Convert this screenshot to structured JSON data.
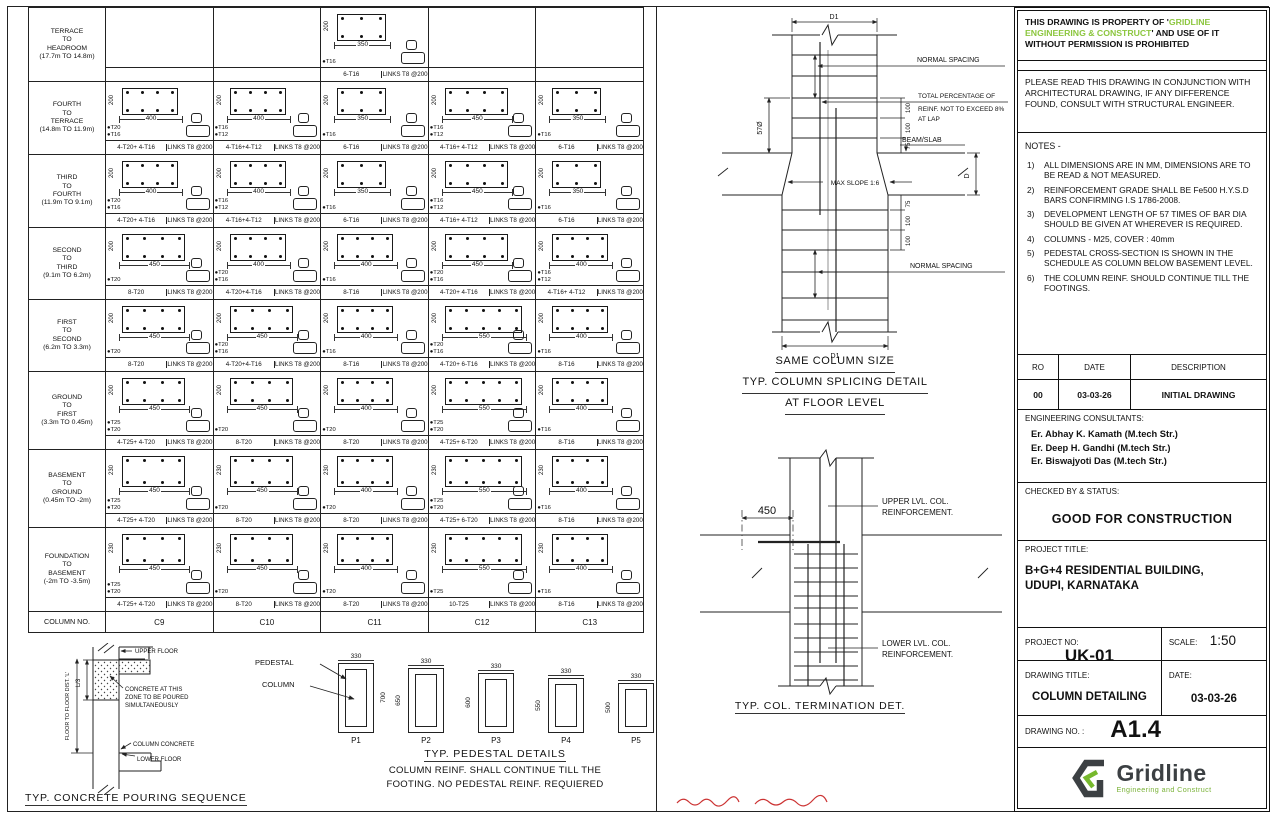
{
  "colors": {
    "accent_green": "#8cc63e",
    "logo_dark": "#3c4043",
    "logo_green": "#76b82d",
    "red_mark": "#cc3333",
    "line": "#222222"
  },
  "schedule": {
    "column_no_label": "COLUMN NO.",
    "columns": [
      "C9",
      "C10",
      "C11",
      "C12",
      "C13"
    ],
    "row_heights": [
      74,
      73,
      73,
      72,
      72,
      78,
      78,
      84
    ],
    "rows": [
      {
        "level": [
          "TERRACE",
          "TO",
          "HEADROOM",
          "(17.7m TO 14.8m)"
        ],
        "cells": [
          null,
          null,
          {
            "w": 350,
            "h": 200,
            "bars": [
              "T16"
            ],
            "main": "6-T16",
            "links": "LINKS T8 @200",
            "n": 6
          },
          null,
          null
        ]
      },
      {
        "level": [
          "FOURTH",
          "TO",
          "TERRACE",
          "(14.8m TO 11.9m)"
        ],
        "cells": [
          {
            "w": 400,
            "h": 200,
            "bars": [
              "T20",
              "T16"
            ],
            "main": "4-T20+ 4-T16",
            "links": "LINKS T8 @200",
            "n": 8
          },
          {
            "w": 400,
            "h": 200,
            "bars": [
              "T16",
              "T12"
            ],
            "main": "4-T16+4-T12",
            "links": "LINKS T8 @200",
            "n": 8
          },
          {
            "w": 350,
            "h": 200,
            "bars": [
              "T16"
            ],
            "main": "6-T16",
            "links": "LINKS T8 @200",
            "n": 6
          },
          {
            "w": 450,
            "h": 200,
            "bars": [
              "T16",
              "T12"
            ],
            "main": "4-T16+ 4-T12",
            "links": "LINKS T8 @200",
            "n": 8
          },
          {
            "w": 350,
            "h": 200,
            "bars": [
              "T16"
            ],
            "main": "6-T16",
            "links": "LINKS T8 @200",
            "n": 6
          }
        ]
      },
      {
        "level": [
          "THIRD",
          "TO",
          "FOURTH",
          "(11.9m TO 9.1m)"
        ],
        "cells": [
          {
            "w": 400,
            "h": 200,
            "bars": [
              "T20",
              "T16"
            ],
            "main": "4-T20+ 4-T16",
            "links": "LINKS T8 @200",
            "n": 8
          },
          {
            "w": 400,
            "h": 200,
            "bars": [
              "T16",
              "T12"
            ],
            "main": "4-T16+4-T12",
            "links": "LINKS T8 @200",
            "n": 8
          },
          {
            "w": 350,
            "h": 200,
            "bars": [
              "T16"
            ],
            "main": "6-T16",
            "links": "LINKS T8 @200",
            "n": 6
          },
          {
            "w": 450,
            "h": 200,
            "bars": [
              "T16",
              "T12"
            ],
            "main": "4-T16+ 4-T12",
            "links": "LINKS T8 @200",
            "n": 8
          },
          {
            "w": 350,
            "h": 200,
            "bars": [
              "T16"
            ],
            "main": "6-T16",
            "links": "LINKS T8 @200",
            "n": 6
          }
        ]
      },
      {
        "level": [
          "SECOND",
          "TO",
          "THIRD",
          "(9.1m TO 6.2m)"
        ],
        "cells": [
          {
            "w": 450,
            "h": 200,
            "bars": [
              "T20"
            ],
            "main": "8-T20",
            "links": "LINKS T8 @200",
            "n": 8
          },
          {
            "w": 400,
            "h": 200,
            "bars": [
              "T20",
              "T16"
            ],
            "main": "4-T20+4-T16",
            "links": "LINKS T8 @200",
            "n": 8
          },
          {
            "w": 400,
            "h": 200,
            "bars": [
              "T16"
            ],
            "main": "8-T16",
            "links": "LINKS T8 @200",
            "n": 8
          },
          {
            "w": 450,
            "h": 200,
            "bars": [
              "T20",
              "T16"
            ],
            "main": "4-T20+ 4-T16",
            "links": "LINKS T8 @200",
            "n": 8
          },
          {
            "w": 400,
            "h": 200,
            "bars": [
              "T16",
              "T12"
            ],
            "main": "4-T16+ 4-T12",
            "links": "LINKS T8 @200",
            "n": 8
          }
        ]
      },
      {
        "level": [
          "FIRST",
          "TO",
          "SECOND",
          "(6.2m TO 3.3m)"
        ],
        "cells": [
          {
            "w": 450,
            "h": 200,
            "bars": [
              "T20"
            ],
            "main": "8-T20",
            "links": "LINKS T8 @200",
            "n": 8
          },
          {
            "w": 450,
            "h": 200,
            "bars": [
              "T20",
              "T16"
            ],
            "main": "4-T20+4-T16",
            "links": "LINKS T8 @200",
            "n": 8
          },
          {
            "w": 400,
            "h": 200,
            "bars": [
              "T16"
            ],
            "main": "8-T16",
            "links": "LINKS T8 @200",
            "n": 8
          },
          {
            "w": 550,
            "h": 200,
            "bars": [
              "T20",
              "T16"
            ],
            "main": "4-T20+ 6-T16",
            "links": "LINKS T8 @200",
            "n": 10
          },
          {
            "w": 400,
            "h": 200,
            "bars": [
              "T16"
            ],
            "main": "8-T16",
            "links": "LINKS T8 @200",
            "n": 8
          }
        ]
      },
      {
        "level": [
          "GROUND",
          "TO",
          "FIRST",
          "(3.3m TO 0.45m)"
        ],
        "cells": [
          {
            "w": 450,
            "h": 200,
            "bars": [
              "T25",
              "T20"
            ],
            "main": "4-T25+ 4-T20",
            "links": "LINKS T8 @200",
            "n": 8
          },
          {
            "w": 450,
            "h": 200,
            "bars": [
              "T20"
            ],
            "main": "8-T20",
            "links": "LINKS T8 @200",
            "n": 8
          },
          {
            "w": 400,
            "h": 200,
            "bars": [
              "T20"
            ],
            "main": "8-T20",
            "links": "LINKS T8 @200",
            "n": 8
          },
          {
            "w": 550,
            "h": 200,
            "bars": [
              "T25",
              "T20"
            ],
            "main": "4-T25+ 6-T20",
            "links": "LINKS T8 @200",
            "n": 10
          },
          {
            "w": 400,
            "h": 200,
            "bars": [
              "T16"
            ],
            "main": "8-T16",
            "links": "LINKS T8 @200",
            "n": 8
          }
        ]
      },
      {
        "level": [
          "BASEMENT",
          "TO",
          "GROUND",
          "(0.45m TO -2m)"
        ],
        "cells": [
          {
            "w": 450,
            "h": 230,
            "bars": [
              "T25",
              "T20"
            ],
            "main": "4-T25+ 4-T20",
            "links": "LINKS T8 @200",
            "n": 8
          },
          {
            "w": 450,
            "h": 230,
            "bars": [
              "T20"
            ],
            "main": "8-T20",
            "links": "LINKS T8 @200",
            "n": 8
          },
          {
            "w": 400,
            "h": 230,
            "bars": [
              "T20"
            ],
            "main": "8-T20",
            "links": "LINKS T8 @200",
            "n": 8
          },
          {
            "w": 550,
            "h": 230,
            "bars": [
              "T25",
              "T20"
            ],
            "main": "4-T25+ 6-T20",
            "links": "LINKS T8 @200",
            "n": 10
          },
          {
            "w": 400,
            "h": 230,
            "bars": [
              "T16"
            ],
            "main": "8-T16",
            "links": "LINKS T8 @200",
            "n": 8
          }
        ]
      },
      {
        "level": [
          "FOUNDATION",
          "TO",
          "BASEMENT",
          "(-2m TO -3.5m)"
        ],
        "cells": [
          {
            "w": 450,
            "h": 230,
            "bars": [
              "T25",
              "T20"
            ],
            "main": "4-T25+ 4-T20",
            "links": "LINKS T8 @200",
            "n": 8
          },
          {
            "w": 450,
            "h": 230,
            "bars": [
              "T20"
            ],
            "main": "8-T20",
            "links": "LINKS T8 @200",
            "n": 8
          },
          {
            "w": 400,
            "h": 230,
            "bars": [
              "T20"
            ],
            "main": "8-T20",
            "links": "LINKS T8 @200",
            "n": 8
          },
          {
            "w": 550,
            "h": 230,
            "bars": [
              "T25"
            ],
            "main": "10-T25",
            "links": "LINKS T8 @200",
            "n": 10
          },
          {
            "w": 400,
            "h": 230,
            "bars": [
              "T16"
            ],
            "main": "8-T16",
            "links": "LINKS T8 @200",
            "n": 8
          }
        ]
      }
    ]
  },
  "pouring": {
    "upper_floor": "UPPER FLOOR",
    "l3": "L/3",
    "floor_dist": "FLOOR TO FLOOR DIST. 'L'",
    "zone1": "CONCRETE AT THIS",
    "zone2": "ZONE TO BE POURED",
    "zone3": "SIMULTANEOUSLY",
    "column_concrete": "COLUMN CONCRETE",
    "lower_floor": "LOWER FLOOR",
    "title": "TYP. CONCRETE POURING SEQUENCE"
  },
  "pedestals": {
    "pedestal_label": "PEDESTAL",
    "column_label": "COLUMN",
    "items": [
      {
        "name": "P1",
        "w": "330",
        "h": "700",
        "hpx": 70,
        "side": "right"
      },
      {
        "name": "P2",
        "w": "330",
        "h": "650",
        "hpx": 65,
        "side": "left"
      },
      {
        "name": "P3",
        "w": "330",
        "h": "600",
        "hpx": 60,
        "side": "left"
      },
      {
        "name": "P4",
        "w": "330",
        "h": "550",
        "hpx": 55,
        "side": "left"
      },
      {
        "name": "P5",
        "w": "330",
        "h": "500",
        "hpx": 50,
        "side": "left"
      }
    ],
    "title": "TYP. PEDESTAL DETAILS",
    "note1": "COLUMN REINF. SHALL CONTINUE TILL THE",
    "note2": "FOOTING. NO PEDESTAL REINF. REQUIERED"
  },
  "splice": {
    "d1": "D1",
    "normal_spacing": "NORMAL SPACING",
    "lap1": "TOTAL PERCENTAGE OF",
    "lap2": "REINF. NOT TO EXCEED 8%",
    "lap3": "AT LAP",
    "lap_len": "57Ø",
    "dims_above": [
      "100",
      "100",
      "75"
    ],
    "dims_below": [
      "75",
      "100",
      "100"
    ],
    "beam_slab": "BEAM/SLAB",
    "slope": "MAX SLOPE 1:6",
    "d": "D",
    "title1": "SAME COLUMN SIZE",
    "title2": "TYP. COLUMN SPLICING DETAIL",
    "title3": "AT FLOOR LEVEL"
  },
  "termination": {
    "dim": "450",
    "upper1": "UPPER LVL. COL.",
    "upper2": "REINFORCEMENT.",
    "lower1": "LOWER LVL. COL.",
    "lower2": "REINFORCEMENT.",
    "title": "TYP. COL. TERMINATION DET."
  },
  "panel": {
    "property": {
      "pre": "THIS DRAWING IS PROPERTY OF '",
      "green": "GRIDLINE ENGINEERING & CONSTRUCT",
      "post": "' AND USE OF IT WITHOUT PERMISSION IS PROHIBITED"
    },
    "conjunction": "PLEASE READ THIS DRAWING IN CONJUNCTION WITH ARCHITECTURAL DRAWING, IF ANY DIFFERENCE FOUND, CONSULT WITH STRUCTURAL ENGINEER.",
    "notes_heading": "NOTES -",
    "notes": [
      {
        "n": "1)",
        "t": "ALL DIMENSIONS ARE IN MM, DIMENSIONS ARE TO BE READ & NOT MEASURED."
      },
      {
        "n": "2)",
        "t": "REINFORCEMENT GRADE SHALL BE Fe500 H.Y.S.D BARS CONFIRMING I.S 1786-2008."
      },
      {
        "n": "3)",
        "t": "DEVELOPMENT LENGTH OF 57 TIMES OF BAR DIA SHOULD BE GIVEN AT WHEREVER IS REQUIRED."
      },
      {
        "n": "4)",
        "t": "COLUMNS - M25, COVER : 40mm"
      },
      {
        "n": "5)",
        "t": "PEDESTAL CROSS-SECTION IS SHOWN IN THE SCHEDULE AS COLUMN BELOW BASEMENT LEVEL."
      },
      {
        "n": "6)",
        "t": "THE COLUMN REINF. SHOULD CONTINUE TILL THE FOOTINGS."
      }
    ],
    "revision": {
      "h1": "RO",
      "h2": "DATE",
      "h3": "DESCRIPTION",
      "r1": "00",
      "r2": "03-03-26",
      "r3": "INITIAL DRAWING"
    },
    "consultants": {
      "heading": "ENGINEERING CONSULTANTS:",
      "name1": "Er. Abhay K. Kamath   (M.tech Str.)",
      "name2": "Er. Deep H. Gandhi   (M.tech Str.)",
      "name3": "Er. Biswajyoti Das   (M.tech Str.)"
    },
    "checked": {
      "label": "CHECKED BY & STATUS:",
      "status": "GOOD FOR CONSTRUCTION"
    },
    "project_title": {
      "label": "PROJECT TITLE:",
      "value1": "B+G+4 RESIDENTIAL BUILDING,",
      "value2": "UDUPI, KARNATAKA"
    },
    "project_no": {
      "label": "PROJECT NO:",
      "value": "UK-01"
    },
    "scale": {
      "label": "SCALE:",
      "value": "1:50"
    },
    "drawing_title": {
      "label": "DRAWING TITLE:",
      "value": "COLUMN DETAILING"
    },
    "date": {
      "label": "DATE:",
      "value": "03-03-26"
    },
    "drawing_no": {
      "label": "DRAWING NO. :",
      "value": "A1.4"
    },
    "logo": {
      "name": "Gridline",
      "tagline": "Engineering and Construct"
    }
  }
}
